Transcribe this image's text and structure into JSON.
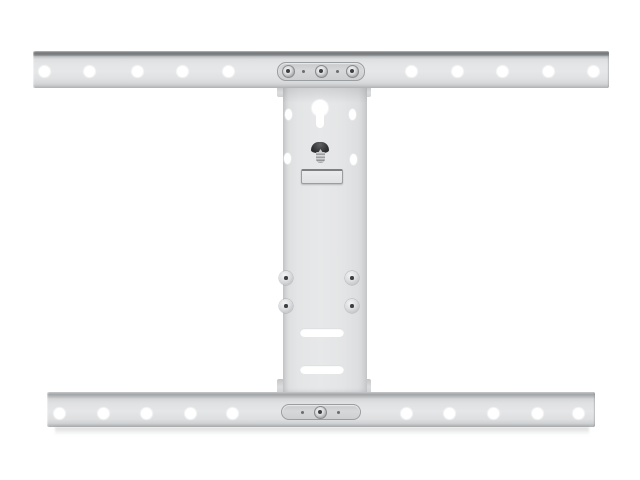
{
  "image": {
    "alt": "White flat TV wall mount bracket: two long horizontal rails with round mounting holes, joined by a vertical wall plate with keyhole slot, dark locking bolt, latch plate, four rivets and two horizontal adjustment slots",
    "background": "#ffffff"
  },
  "colors": {
    "background": "#ffffff",
    "hole_white": "#ffffff",
    "rail_body": "#e4e5e6",
    "rail_top_dark": "#747779",
    "rail_bottom": "#a9acae",
    "plate_fill": "#e6e7e8",
    "plate_edge": "#c9cbcd",
    "clamp_fill": "#d6d8da",
    "clamp_border": "#9b9ea0",
    "screw_dark": "#3d3f41",
    "bolt_head": "#2d2f31",
    "shadow_gray": "#787b7d"
  },
  "top_rail": {
    "holes_y": 71,
    "holes_x": [
      44,
      89,
      137,
      182,
      228,
      411,
      457,
      502,
      548,
      593
    ],
    "clamp": {
      "y": 71,
      "screws_x": [
        288,
        321,
        352
      ],
      "pins_x": [
        303,
        337
      ]
    }
  },
  "bottom_rail": {
    "holes_y": 413,
    "holes_x": [
      59,
      103,
      146,
      190,
      232,
      406,
      449,
      493,
      537,
      578
    ],
    "clamp": {
      "y": 412,
      "screws_x": [
        320
      ],
      "pins_x": [
        302,
        338
      ]
    }
  },
  "center_plate": {
    "oval_holes": [
      [
        288,
        114
      ],
      [
        352,
        114
      ],
      [
        287,
        158
      ],
      [
        353,
        159
      ]
    ],
    "rivets": [
      [
        286,
        278
      ],
      [
        352,
        278
      ],
      [
        286,
        306
      ],
      [
        352,
        306
      ]
    ],
    "slots": [
      [
        322,
        332
      ],
      [
        322,
        369
      ]
    ]
  }
}
